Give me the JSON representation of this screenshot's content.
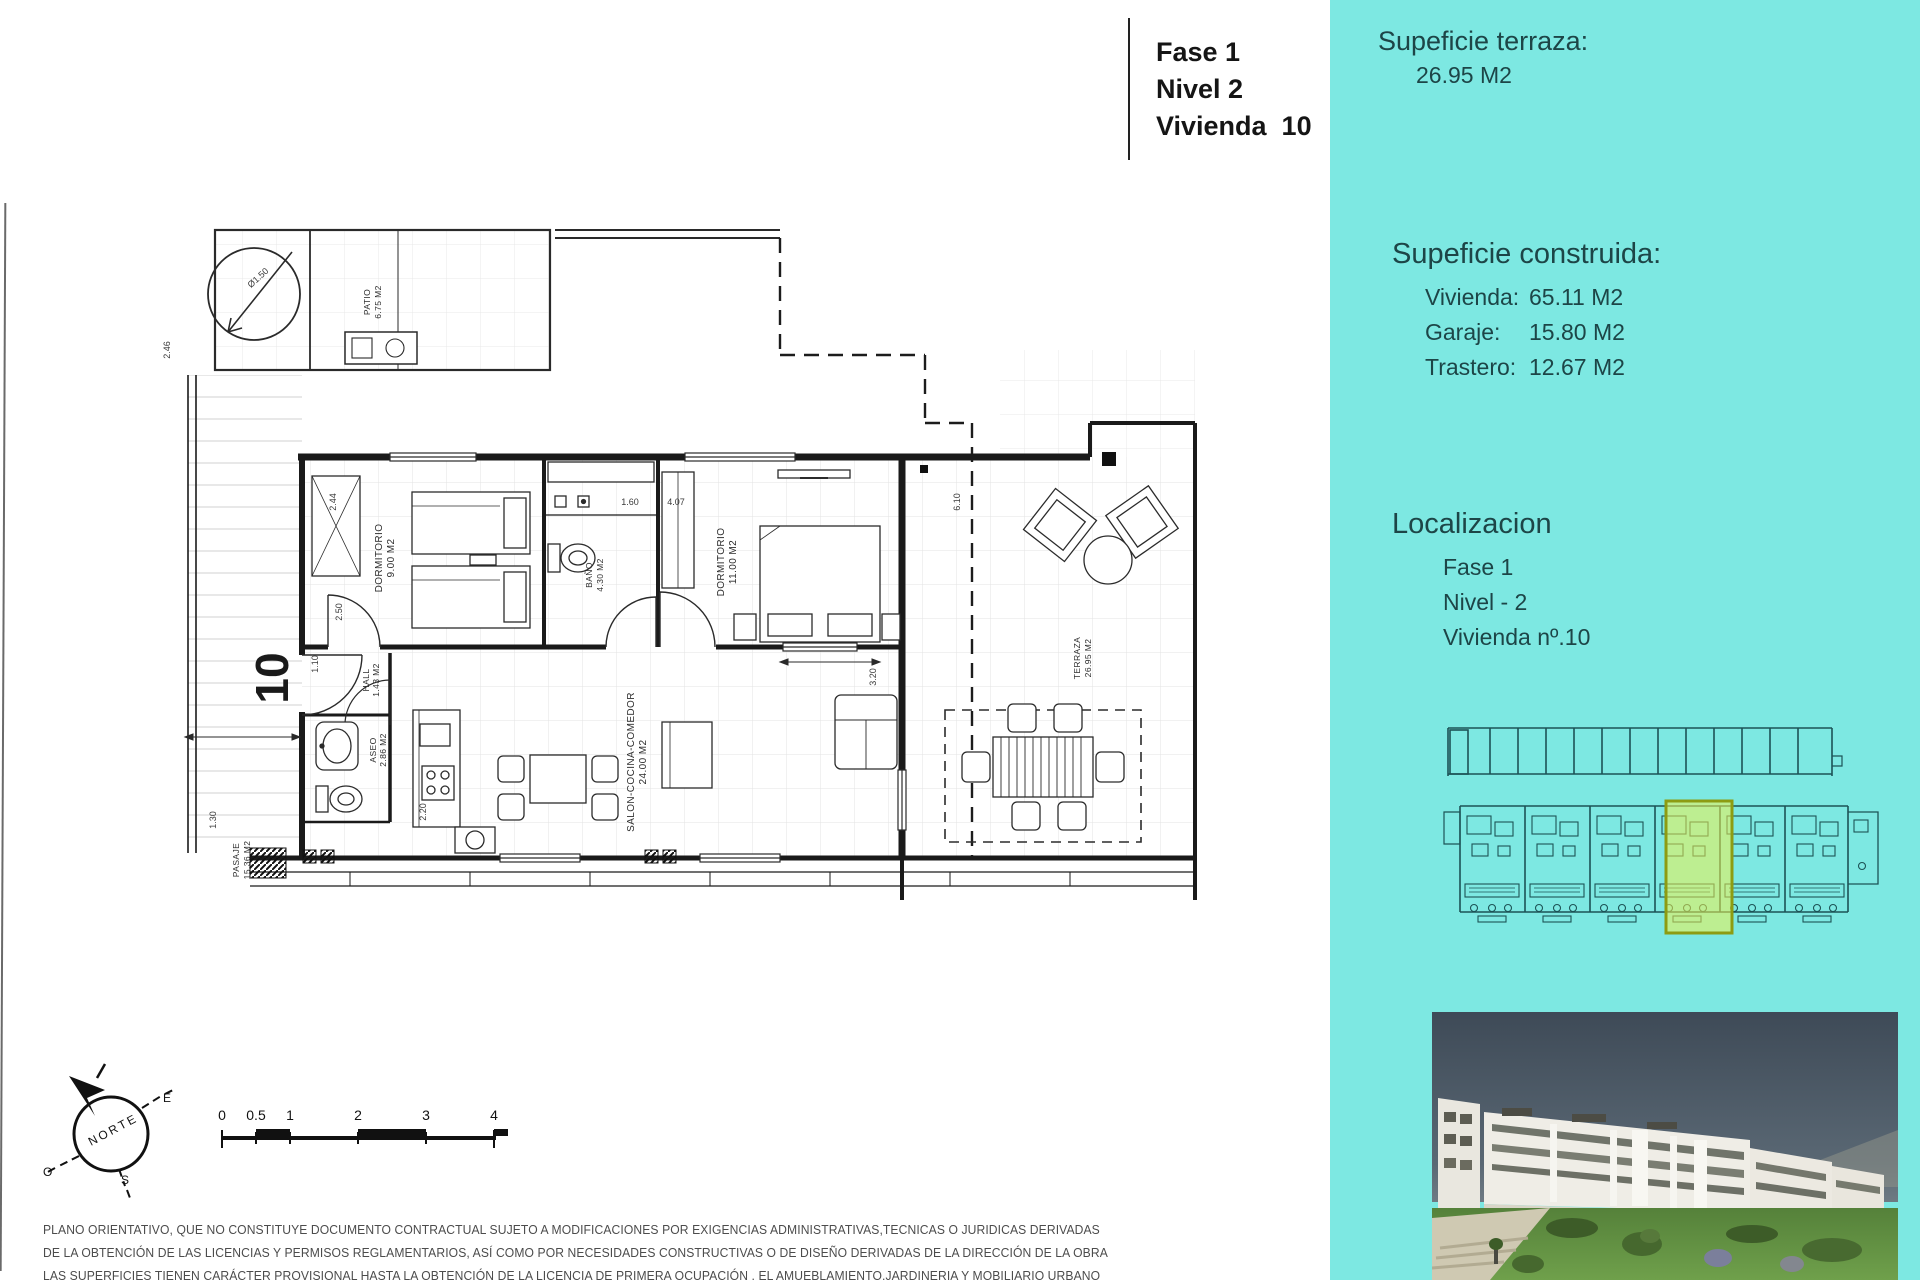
{
  "title_block": {
    "lines": [
      "Fase 1",
      "Nivel 2",
      "Vivienda  10"
    ]
  },
  "sidebar": {
    "bg_color": "#7de8e2",
    "text_color": "#1d4547",
    "terraza_heading": "Supeficie terraza:",
    "terraza_value": "26.95 M2",
    "construida_heading": "Supeficie construida:",
    "construida_rows": [
      {
        "label": "Vivienda:",
        "value": "65.11 M2"
      },
      {
        "label": "Garaje:",
        "value": "15.80 M2"
      },
      {
        "label": "Trastero:",
        "value": "12.67 M2"
      }
    ],
    "localizacion_heading": "Localizacion",
    "localizacion_lines": [
      "Fase 1",
      "Nivel - 2",
      "Vivienda nº.10"
    ],
    "siteplan_highlight_color": "#f2f24e"
  },
  "floor_plan": {
    "unit_number": "10",
    "rooms": [
      {
        "name": "patio",
        "label": "PATIO",
        "area": "6.75 M2"
      },
      {
        "name": "dormitorio-1",
        "label": "DORMITORIO",
        "area": "9.00 M2"
      },
      {
        "name": "bano",
        "label": "BAÑO",
        "area": "4.30 M2"
      },
      {
        "name": "dormitorio-2",
        "label": "DORMITORIO",
        "area": "11.00 M2"
      },
      {
        "name": "hall",
        "label": "HALL",
        "area": "1.43 M2"
      },
      {
        "name": "aseo",
        "label": "ASEO",
        "area": "2.86 M2"
      },
      {
        "name": "salon",
        "label": "SALON-COCINA-COMEDOR",
        "area": "24.00 M2"
      },
      {
        "name": "terraza",
        "label": "TERRAZA",
        "area": "26.95 M2"
      },
      {
        "name": "pasaje",
        "label": "PASAJE",
        "area": "15.36 M2"
      }
    ],
    "dimensions": [
      "2.46",
      "2.44",
      "2.50",
      "1.10",
      "1.30",
      "2.20",
      "1.60",
      "4.07",
      "6.10",
      "3.20",
      "Ø1.50"
    ]
  },
  "compass": {
    "label": "NORTE",
    "east": "E",
    "west": "O",
    "south": "S"
  },
  "scale_bar": {
    "ticks": [
      "0",
      "0.5",
      "1",
      "2",
      "3",
      "4"
    ]
  },
  "disclaimer": {
    "lines": [
      "PLANO ORIENTATIVO, QUE NO CONSTITUYE DOCUMENTO CONTRACTUAL SUJETO A MODIFICACIONES POR EXIGENCIAS ADMINISTRATIVAS,TECNICAS O JURIDICAS DERIVADAS",
      "DE LA OBTENCIÓN DE LAS LICENCIAS Y PERMISOS REGLAMENTARIOS, ASÍ COMO POR NECESIDADES CONSTRUCTIVAS  O DE DISEÑO DERIVADAS DE LA DIRECCIÓN DE LA OBRA",
      "LAS SUPERFICIES TIENEN CARÁCTER PROVISIONAL HASTA LA OBTENCIÓN DE LA LICENCIA DE PRIMERA OCUPACIÓN , EL AMUEBLAMIENTO,JARDINERIA Y MOBILIARIO URBANO"
    ]
  }
}
